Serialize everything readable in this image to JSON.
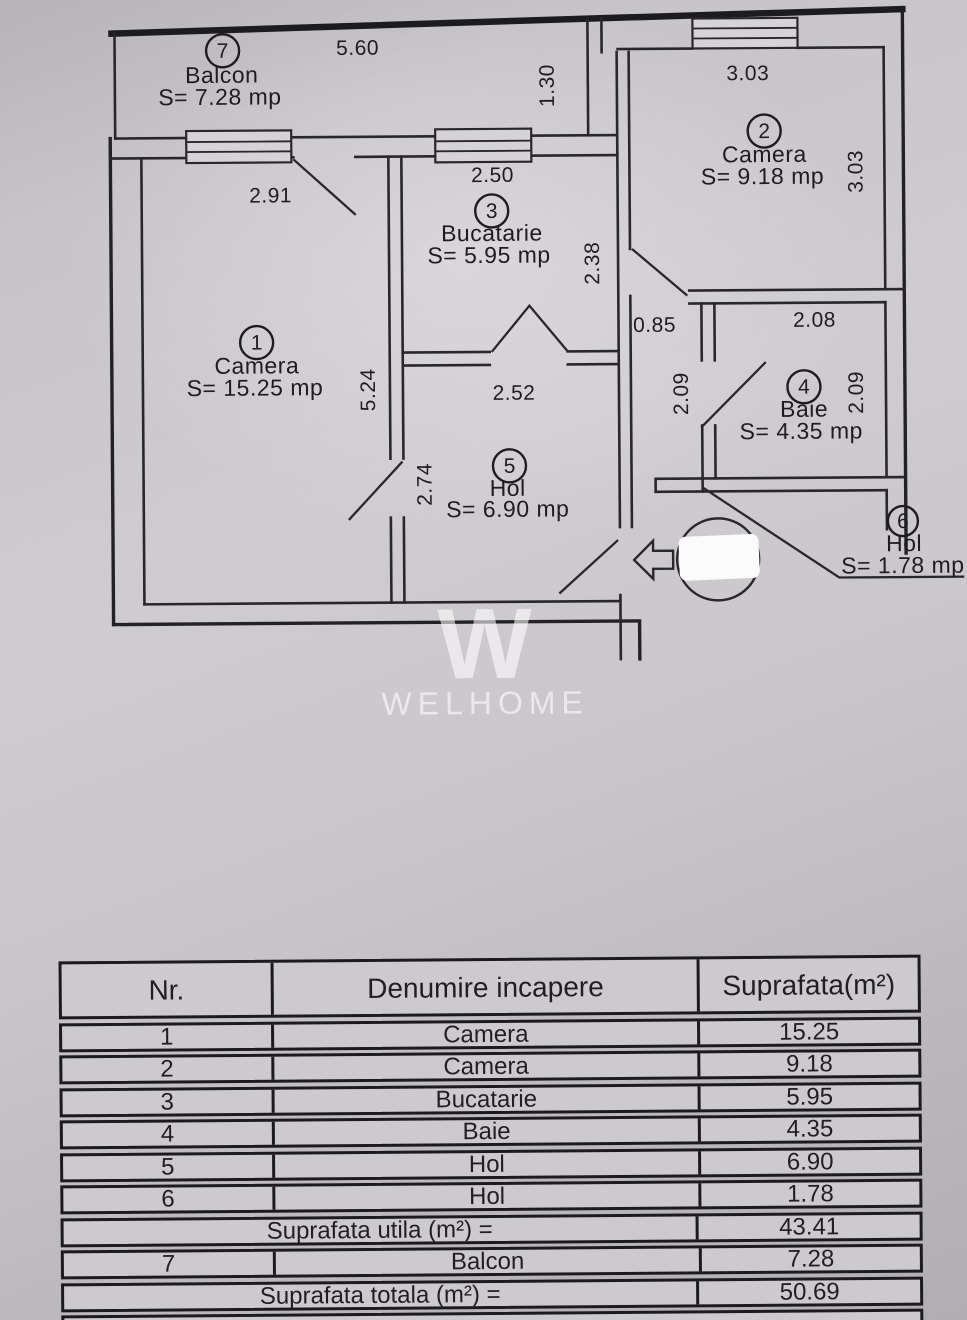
{
  "plan": {
    "rooms": [
      {
        "number": "1",
        "name": "Camera",
        "area": "S= 15.25 mp"
      },
      {
        "number": "2",
        "name": "Camera",
        "area": "S= 9.18 mp"
      },
      {
        "number": "3",
        "name": "Bucatarie",
        "area": "S= 5.95 mp"
      },
      {
        "number": "4",
        "name": "Baie",
        "area": "S= 4.35 mp"
      },
      {
        "number": "5",
        "name": "Hol",
        "area": "S= 6.90 mp"
      },
      {
        "number": "6",
        "name": "Hol",
        "area": "S= 1.78 mp"
      },
      {
        "number": "7",
        "name": "Balcon",
        "area": "S= 7.28 mp"
      }
    ],
    "dims": {
      "balcony_width": "5.60",
      "balcony_depth": "1.30",
      "camera2_width": "3.03",
      "camera2_height": "3.03",
      "camera1_width": "2.91",
      "camera1_height": "5.24",
      "kitchen_width": "2.50",
      "kitchen_height": "2.38",
      "corridor_width": "0.85",
      "corridor_height": "2.09",
      "baie_width": "2.08",
      "baie_height": "2.09",
      "hol_width": "2.52",
      "hol_height": "2.74"
    }
  },
  "watermark": {
    "mark": "W",
    "text": "WELHOME"
  },
  "table": {
    "headers": [
      "Nr.",
      "Denumire incapere",
      "Suprafata(m²)"
    ],
    "rows": [
      {
        "nr": "1",
        "name": "Camera",
        "area": "15.25"
      },
      {
        "nr": "2",
        "name": "Camera",
        "area": "9.18"
      },
      {
        "nr": "3",
        "name": "Bucatarie",
        "area": "5.95"
      },
      {
        "nr": "4",
        "name": "Baie",
        "area": "4.35"
      },
      {
        "nr": "5",
        "name": "Hol",
        "area": "6.90"
      },
      {
        "nr": "6",
        "name": "Hol",
        "area": "1.78"
      }
    ],
    "utila": {
      "label": "Suprafata utila (m²) =",
      "value": "43.41"
    },
    "balcon_row": {
      "nr": "7",
      "name": "Balcon",
      "area": "7.28"
    },
    "totala": {
      "label": "Suprafata totala (m²) =",
      "value": "50.69"
    }
  }
}
